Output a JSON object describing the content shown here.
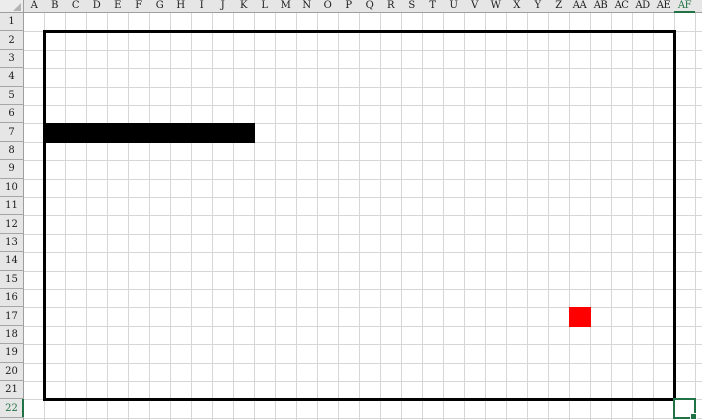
{
  "sheet": {
    "column_headers": [
      "A",
      "B",
      "C",
      "D",
      "E",
      "F",
      "G",
      "H",
      "I",
      "J",
      "K",
      "L",
      "M",
      "N",
      "O",
      "P",
      "Q",
      "R",
      "S",
      "T",
      "U",
      "V",
      "W",
      "X",
      "Y",
      "Z",
      "AA",
      "AB",
      "AC",
      "AD",
      "AE",
      "AF"
    ],
    "row_headers": [
      "1",
      "2",
      "3",
      "4",
      "5",
      "6",
      "7",
      "8",
      "9",
      "10",
      "11",
      "12",
      "13",
      "14",
      "15",
      "16",
      "17",
      "18",
      "19",
      "20",
      "21",
      "22"
    ]
  },
  "selection": {
    "active_cell": "AF22",
    "highlighted_column": "AF",
    "highlighted_row": "22"
  },
  "board": {
    "wall_border_range": "B2:AE21",
    "snake": {
      "cells": [
        "B7",
        "C7",
        "D7",
        "E7",
        "F7",
        "G7",
        "H7",
        "I7",
        "J7",
        "K7"
      ],
      "color": "#000000"
    },
    "food": {
      "cell": "AA17",
      "color": "#ff0000"
    }
  },
  "colors": {
    "header_background": "#e6e6e6",
    "header_border": "#9e9e9e",
    "gridline": "#d6d6d6",
    "selection_accent": "#217346",
    "wall_border": "#000000",
    "cell_background": "#ffffff"
  }
}
